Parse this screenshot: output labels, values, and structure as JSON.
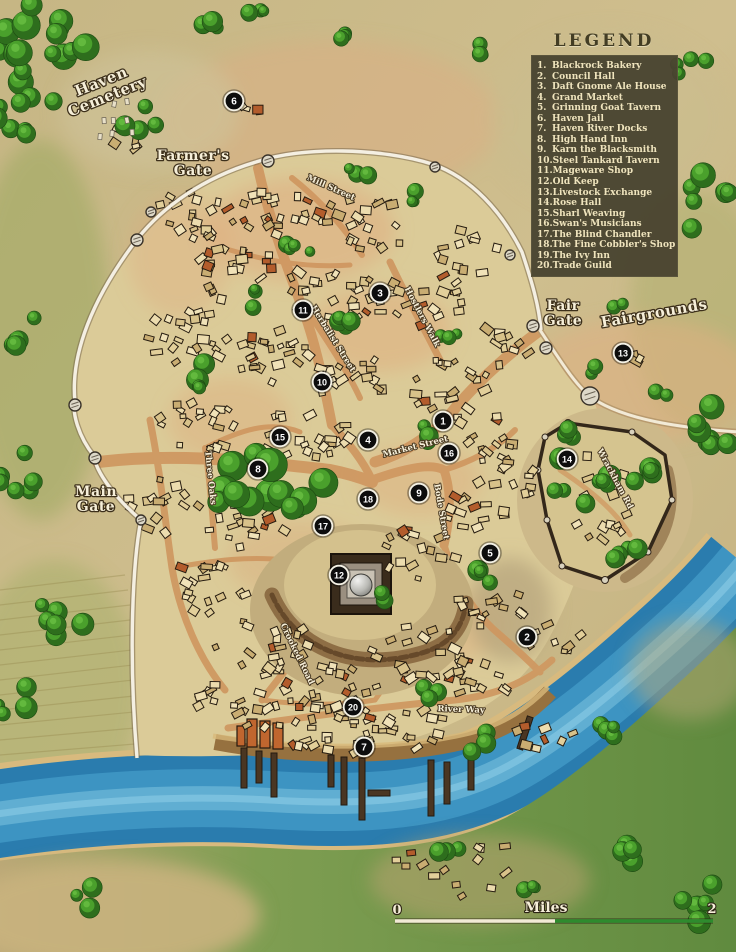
{
  "legend": {
    "title": "LEGEND",
    "items": [
      {
        "num": "1.",
        "label": "Blackrock Bakery"
      },
      {
        "num": "2.",
        "label": "Council Hall"
      },
      {
        "num": "3.",
        "label": "Daft Gnome Ale House"
      },
      {
        "num": "4.",
        "label": "Grand Market"
      },
      {
        "num": "5.",
        "label": "Grinning Goat Tavern"
      },
      {
        "num": "6.",
        "label": "Haven Jail"
      },
      {
        "num": "7.",
        "label": "Haven River Docks"
      },
      {
        "num": "8.",
        "label": "High Hand Inn"
      },
      {
        "num": "9.",
        "label": "Karn the Blacksmith"
      },
      {
        "num": "10.",
        "label": "Steel Tankard Tavern"
      },
      {
        "num": "11.",
        "label": "Mageware Shop"
      },
      {
        "num": "12.",
        "label": "Old Keep"
      },
      {
        "num": "13.",
        "label": "Livestock Exchange"
      },
      {
        "num": "14.",
        "label": "Rose Hall"
      },
      {
        "num": "15.",
        "label": "Sharl Weaving"
      },
      {
        "num": "16.",
        "label": "Swan's Musicians"
      },
      {
        "num": "17.",
        "label": "The Blind Chandler"
      },
      {
        "num": "18.",
        "label": "The Fine Cobbler's Shop"
      },
      {
        "num": "19.",
        "label": "The Ivy Inn"
      },
      {
        "num": "20.",
        "label": "Trade Guild"
      }
    ]
  },
  "map_labels": [
    {
      "text": "Haven\nCemetery",
      "x": 103,
      "y": 86,
      "rot": -22,
      "size": 15,
      "cls": "place"
    },
    {
      "text": "Farmer's\nGate",
      "x": 193,
      "y": 160,
      "rot": 0,
      "size": 14,
      "cls": "place"
    },
    {
      "text": "Fair\nGate",
      "x": 563,
      "y": 310,
      "rot": 0,
      "size": 14,
      "cls": "place"
    },
    {
      "text": "Fairgrounds",
      "x": 655,
      "y": 318,
      "rot": -10,
      "size": 15,
      "cls": "place"
    },
    {
      "text": "Main\nGate",
      "x": 96,
      "y": 496,
      "rot": 0,
      "size": 14,
      "cls": "place"
    },
    {
      "text": "Mill Street",
      "x": 330,
      "y": 190,
      "rot": 24,
      "size": 8.5,
      "cls": "street"
    },
    {
      "text": "Hostlers Walk",
      "x": 420,
      "y": 318,
      "rot": 62,
      "size": 8.5,
      "cls": "street"
    },
    {
      "text": "Herbalist Street",
      "x": 331,
      "y": 340,
      "rot": 58,
      "size": 8.5,
      "cls": "street"
    },
    {
      "text": "Market Street",
      "x": 416,
      "y": 449,
      "rot": -14,
      "size": 8.5,
      "cls": "street"
    },
    {
      "text": "Bode Street",
      "x": 439,
      "y": 512,
      "rot": 80,
      "size": 8.5,
      "cls": "street"
    },
    {
      "text": "Three Oaks",
      "x": 208,
      "y": 478,
      "rot": 84,
      "size": 8.5,
      "cls": "street"
    },
    {
      "text": "Wrackham Rd",
      "x": 613,
      "y": 480,
      "rot": 62,
      "size": 8.5,
      "cls": "street"
    },
    {
      "text": "Crooked Road",
      "x": 295,
      "y": 655,
      "rot": 64,
      "size": 8.5,
      "cls": "street"
    },
    {
      "text": "River Way",
      "x": 461,
      "y": 712,
      "rot": 2,
      "size": 8.5,
      "cls": "street"
    }
  ],
  "markers": [
    {
      "n": "1",
      "x": 443,
      "y": 421
    },
    {
      "n": "2",
      "x": 527,
      "y": 637
    },
    {
      "n": "3",
      "x": 380,
      "y": 293
    },
    {
      "n": "4",
      "x": 368,
      "y": 440
    },
    {
      "n": "5",
      "x": 490,
      "y": 553
    },
    {
      "n": "6",
      "x": 234,
      "y": 101
    },
    {
      "n": "7",
      "x": 364,
      "y": 747
    },
    {
      "n": "8",
      "x": 258,
      "y": 469
    },
    {
      "n": "9",
      "x": 419,
      "y": 493
    },
    {
      "n": "10",
      "x": 322,
      "y": 382
    },
    {
      "n": "11",
      "x": 303,
      "y": 310
    },
    {
      "n": "12",
      "x": 339,
      "y": 575
    },
    {
      "n": "13",
      "x": 623,
      "y": 353
    },
    {
      "n": "14",
      "x": 567,
      "y": 459
    },
    {
      "n": "15",
      "x": 280,
      "y": 437
    },
    {
      "n": "16",
      "x": 449,
      "y": 453
    },
    {
      "n": "17",
      "x": 323,
      "y": 526
    },
    {
      "n": "18",
      "x": 368,
      "y": 499
    },
    {
      "n": "20",
      "x": 353,
      "y": 707
    }
  ],
  "scale": {
    "left": "0",
    "center": "Miles",
    "right": "2"
  },
  "colors": {
    "parchment": "#c9b98a",
    "town_ground": "#dbcb98",
    "road": "#cf9760",
    "river": "#2a7cae",
    "forest": "#2e6e1d",
    "tree": "#4aa02c",
    "wall": "#f4efe2",
    "legend_bg": "#494430",
    "legend_text": "#efe4bd",
    "marker": "#0d0d0d",
    "scale_green": "#2e8b2e"
  }
}
